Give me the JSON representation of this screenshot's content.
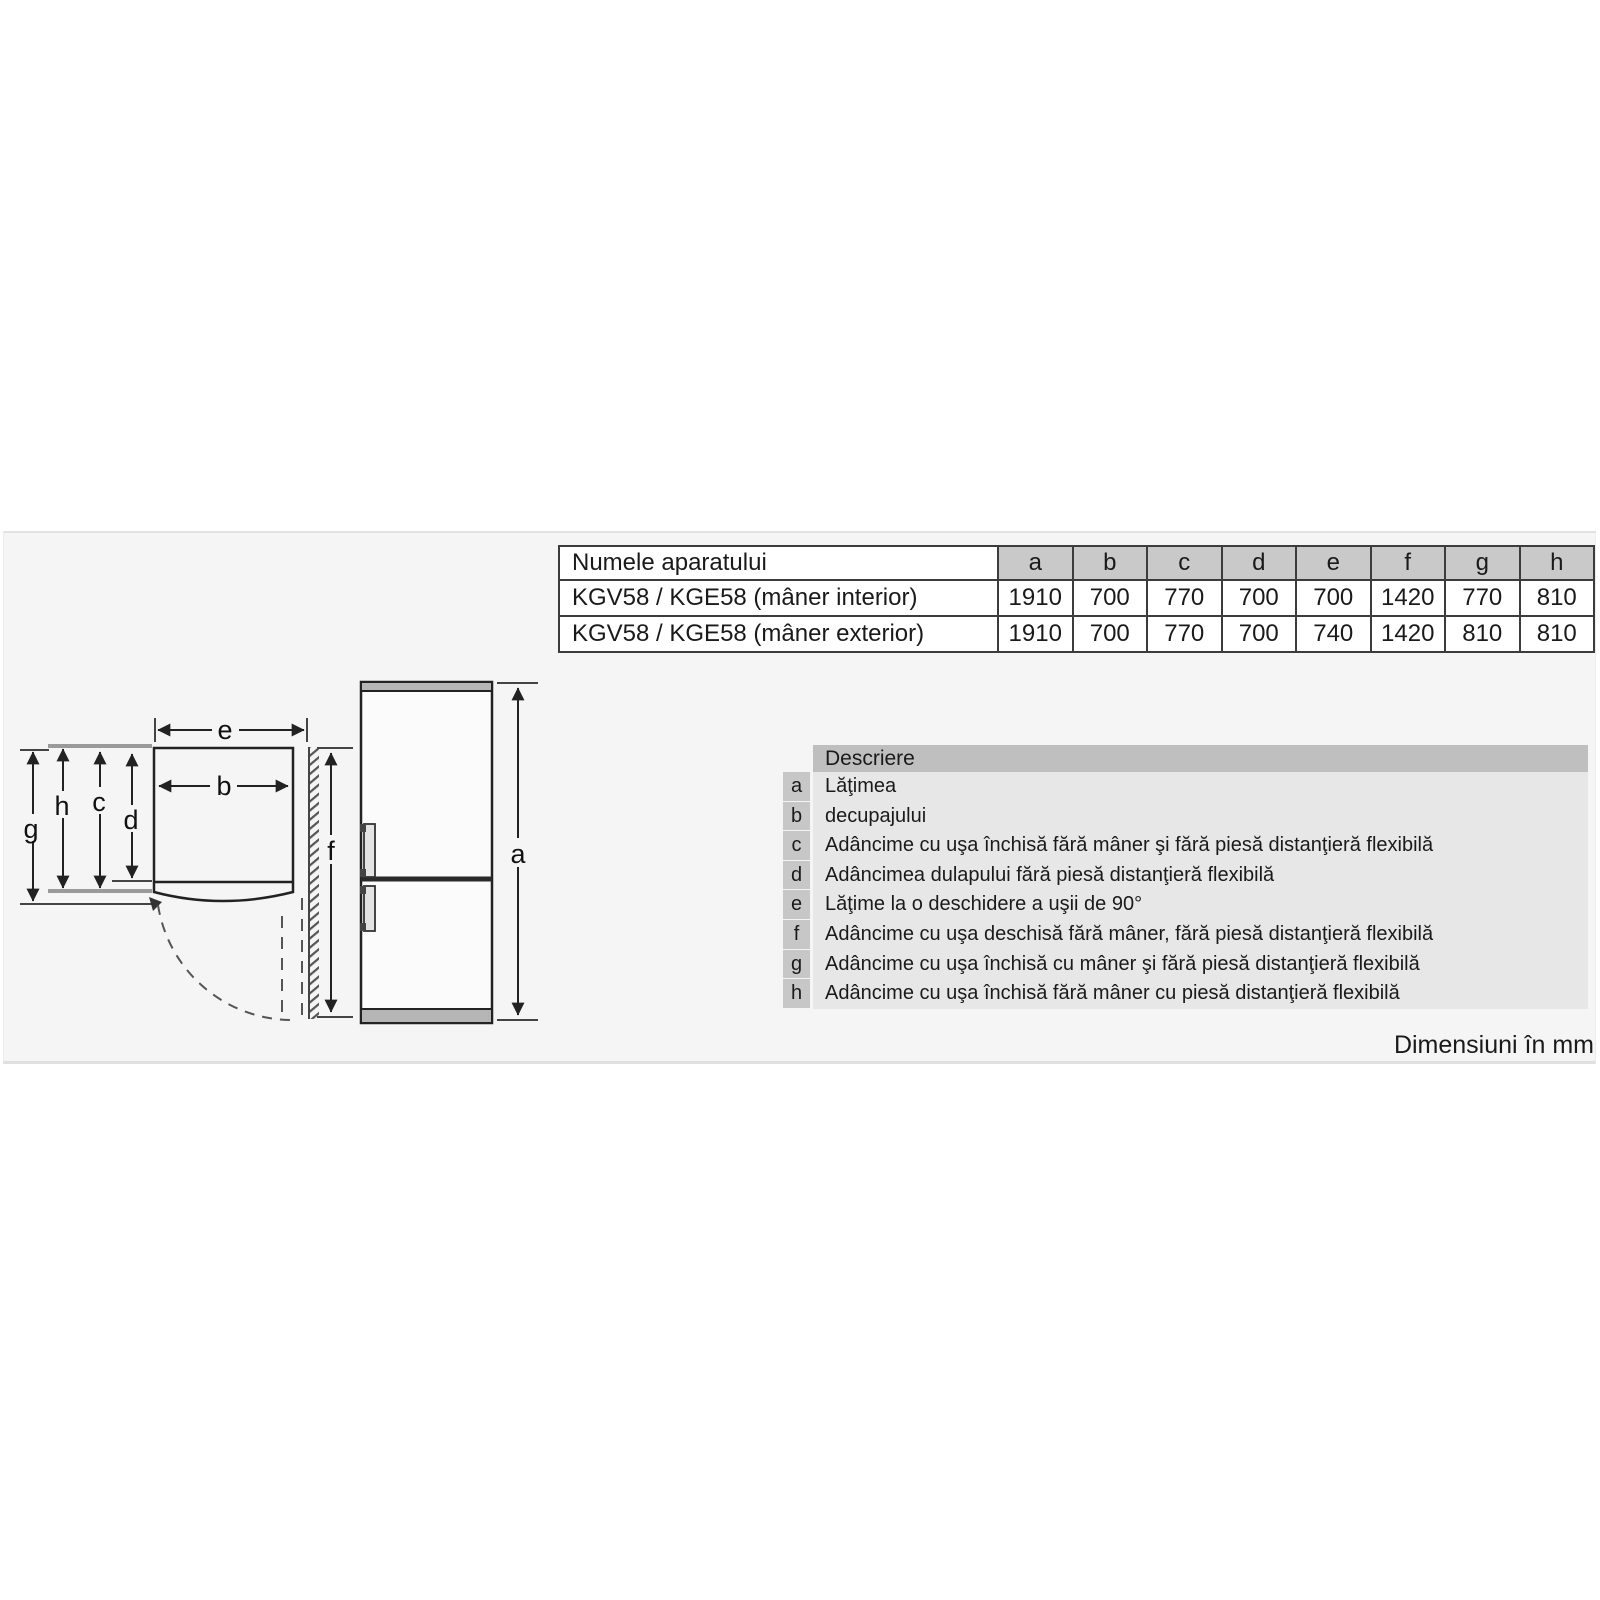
{
  "colors": {
    "content_bg": "#f5f5f5",
    "table_header_bg": "#c9c9c9",
    "desc_header_bg": "#bfbfbf",
    "desc_letter_bg": "#c7c7c7",
    "desc_body_bg": "#e7e7e7",
    "line_dark": "#222222",
    "line_gray": "#9a9a9a"
  },
  "dimensions_table": {
    "name_header": "Numele aparatului",
    "columns": [
      "a",
      "b",
      "c",
      "d",
      "e",
      "f",
      "g",
      "h"
    ],
    "rows": [
      {
        "name": "KGV58 / KGE58 (mâner interior)",
        "values": [
          "1910",
          "700",
          "770",
          "700",
          "700",
          "1420",
          "770",
          "810"
        ]
      },
      {
        "name": "KGV58 / KGE58 (mâner exterior)",
        "values": [
          "1910",
          "700",
          "770",
          "700",
          "740",
          "1420",
          "810",
          "810"
        ]
      }
    ]
  },
  "descriptions": {
    "header": "Descriere",
    "rows": [
      {
        "letter": "a",
        "text": "Lăţimea"
      },
      {
        "letter": "b",
        "text": "decupajului"
      },
      {
        "letter": "c",
        "text": "Adâncime cu uşa închisă fără mâner şi fără piesă distanţieră flexibilă"
      },
      {
        "letter": "d",
        "text": "Adâncimea dulapului fără piesă distanţieră flexibilă"
      },
      {
        "letter": "e",
        "text": "Lăţime la o deschidere a uşii de 90°"
      },
      {
        "letter": "f",
        "text": "Adâncime cu uşa deschisă fără mâner, fără piesă distanţieră flexibilă"
      },
      {
        "letter": "g",
        "text": "Adâncime cu uşa închisă cu mâner şi fără piesă distanţieră flexibilă"
      },
      {
        "letter": "h",
        "text": "Adâncime cu uşa închisă fără mâner cu piesă distanţieră flexibilă"
      }
    ]
  },
  "diagram_labels": {
    "a": "a",
    "b": "b",
    "c": "c",
    "d": "d",
    "e": "e",
    "f": "f",
    "g": "g",
    "h": "h"
  },
  "footer_note": "Dimensiuni în mm"
}
